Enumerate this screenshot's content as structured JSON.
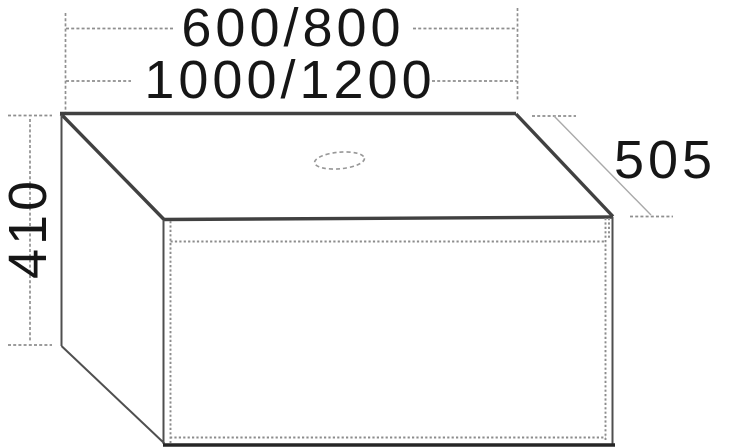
{
  "drawing": {
    "kind": "furniture-dimension-diagram",
    "dimensions": {
      "width_row1": "600/800",
      "width_row2": "1000/1200",
      "depth": "505",
      "height": "410"
    },
    "colors": {
      "background": "#ffffff",
      "outline_strong": "#414141",
      "outline_medium": "#4f4f4f",
      "outline_dotted": "#8c8c8c",
      "dimension_line": "#8f8f8f",
      "text": "#161616"
    }
  }
}
